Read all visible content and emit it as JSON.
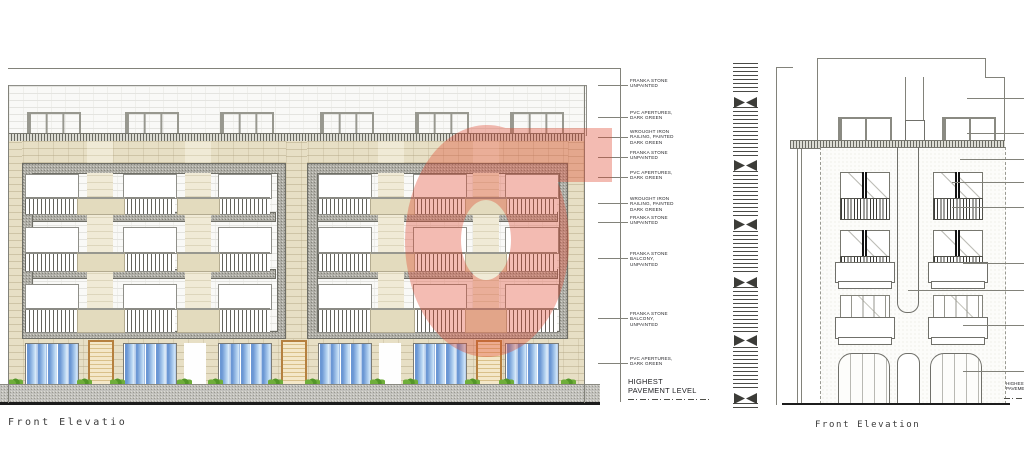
{
  "titles": {
    "left": "Front Elevatio",
    "right": "Front Elevation"
  },
  "annotations": {
    "left": [
      {
        "text": "FRANKA STONE\nUNPAINTED"
      },
      {
        "text": "PVC APERTURES,\nDARK GREEN"
      },
      {
        "text": "WROUGHT IRON\nRAILING, PAINTED\nDARK GREEN"
      },
      {
        "text": "FRANKA STONE\nUNPAINTED"
      },
      {
        "text": "PVC APERTURES,\nDARK GREEN"
      },
      {
        "text": "WROUGHT IRON\nRAILING, PAINTED\nDARK GREEN"
      },
      {
        "text": "FRANKA STONE\nUNPAINTED"
      },
      {
        "text": "FRANKA STONE\nBALCONY, UNPAINTED"
      },
      {
        "text": "FRANKA STONE\nBALCONY, UNPAINTED"
      },
      {
        "text": "PVC APERTURES,\nDARK GREEN"
      }
    ],
    "left_pavement": "HIGHEST\nPAVEMENT LEVEL",
    "right_pavement": "HIGHEST\nPAVEMENT LEVEL"
  },
  "watermark": {
    "glyph": "G",
    "color": "#e0462d",
    "opacity": 0.36
  },
  "colors": {
    "stone_beige": "#e7dfc5",
    "stone_cream": "#f0ead6",
    "frame_gray": "#aeada6",
    "glass_blue": "#6f9fd8",
    "shrub_green": "#6fae3a",
    "door_tan": "#f4e7c8",
    "door_tan_border": "#b5803f",
    "pavement_gray": "#c2c1bd"
  }
}
